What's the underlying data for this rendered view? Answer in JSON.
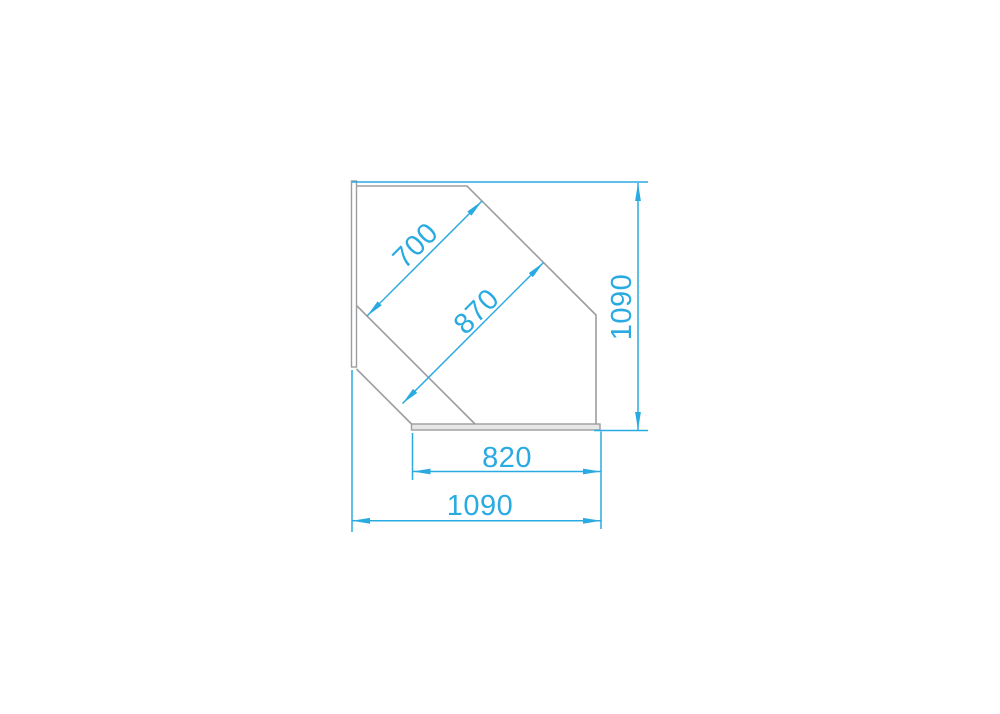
{
  "page": {
    "background": "#ffffff",
    "description": "CAD technical drawing of a corner display counter profile with blue dimension lines"
  },
  "colors": {
    "dimension_blue": "#29abe2",
    "outline_gray": "#9b9da0",
    "panel_fill": "#e7e7e7"
  },
  "dimensions": {
    "glass_upper": "700",
    "glass_lower": "870",
    "height_right": "1090",
    "base_width": "820",
    "overall_width": "1090"
  }
}
